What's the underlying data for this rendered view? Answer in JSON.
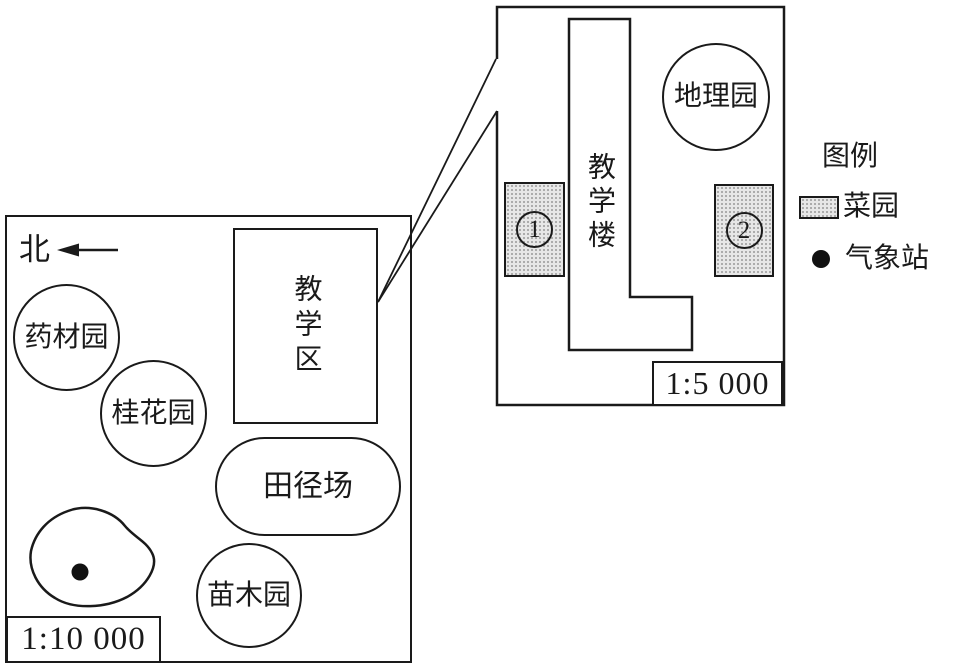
{
  "colors": {
    "ink": "#1a1a1a",
    "shade_background": "#e7e7e7",
    "shade_dot": "#9d9d9d"
  },
  "overview_map": {
    "north_label": "北",
    "scale_label": "1:10 000",
    "herb_garden_label": "药材园",
    "osmanthus_garden_label": "桂花园",
    "teaching_area_label": "教学区",
    "track_field_label": "田径场",
    "nursery_garden_label": "苗木园"
  },
  "detail_map": {
    "scale_label": "1:5 000",
    "teaching_building_label": "教学楼",
    "geography_garden_label": "地理园",
    "plot1": {
      "label": "①",
      "digit": "1"
    },
    "plot2": {
      "label": "②",
      "digit": "2"
    }
  },
  "legend": {
    "title": "图例",
    "vegetable_garden_label": "菜园",
    "weather_station_label": "气象站"
  }
}
